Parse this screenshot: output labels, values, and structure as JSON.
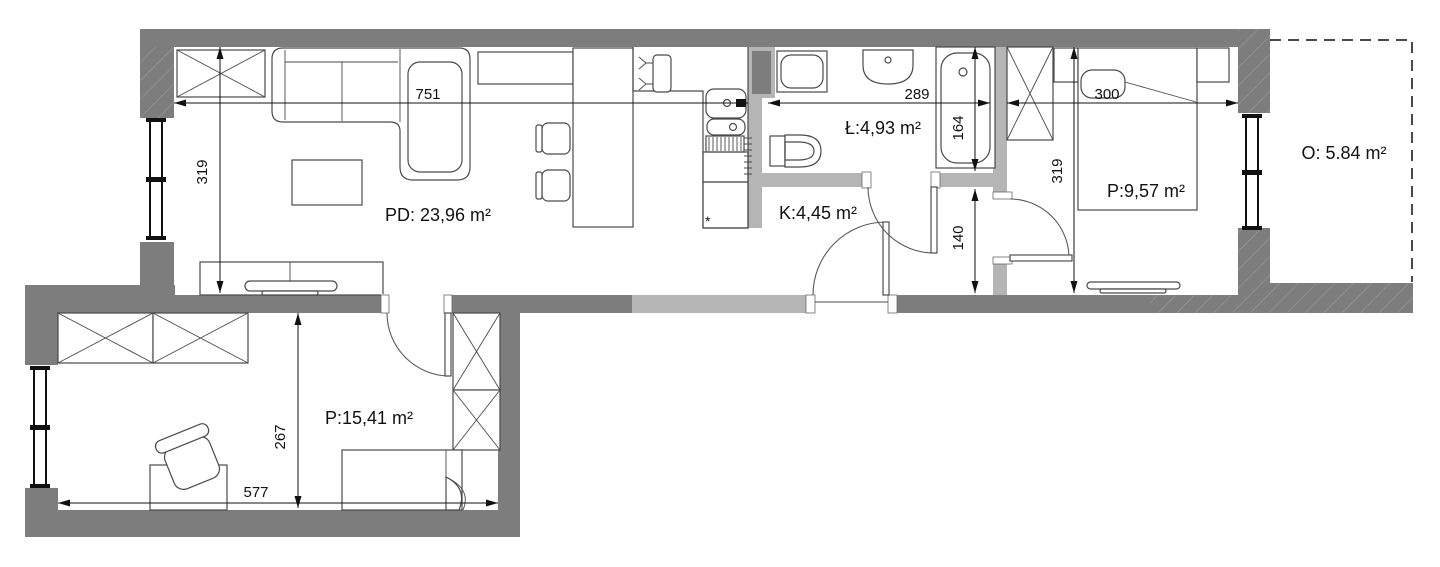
{
  "title": "apartment-floor-plan",
  "colors": {
    "wall_dark": "#7d7d7d",
    "wall_light": "#b5b5b5",
    "furniture_outline": "#4a4a4a",
    "dimension_text": "#111111",
    "background": "#ffffff"
  },
  "rooms": {
    "living": {
      "label": "PD: 23,96 m²"
    },
    "bathroom": {
      "label": "Ł:4,93 m²"
    },
    "corridor": {
      "label": "K:4,45 m²"
    },
    "bedroom": {
      "label": "P:9,57 m²"
    },
    "balcony": {
      "label": "O: 5.84 m²"
    },
    "room2": {
      "label": "P:15,41 m²"
    }
  },
  "dimensions": {
    "living_width": {
      "label": "751"
    },
    "living_height": {
      "label": "319"
    },
    "bathroom_width": {
      "label": "289"
    },
    "bathroom_height": {
      "label": "164"
    },
    "bedroom_width": {
      "label": "300"
    },
    "bedroom_height": {
      "label": "319"
    },
    "corridor_height": {
      "label": "140"
    },
    "room2_width": {
      "label": "577"
    },
    "room2_height": {
      "label": "267"
    }
  },
  "annotations": {
    "fridge_mark": {
      "label": "*"
    }
  }
}
